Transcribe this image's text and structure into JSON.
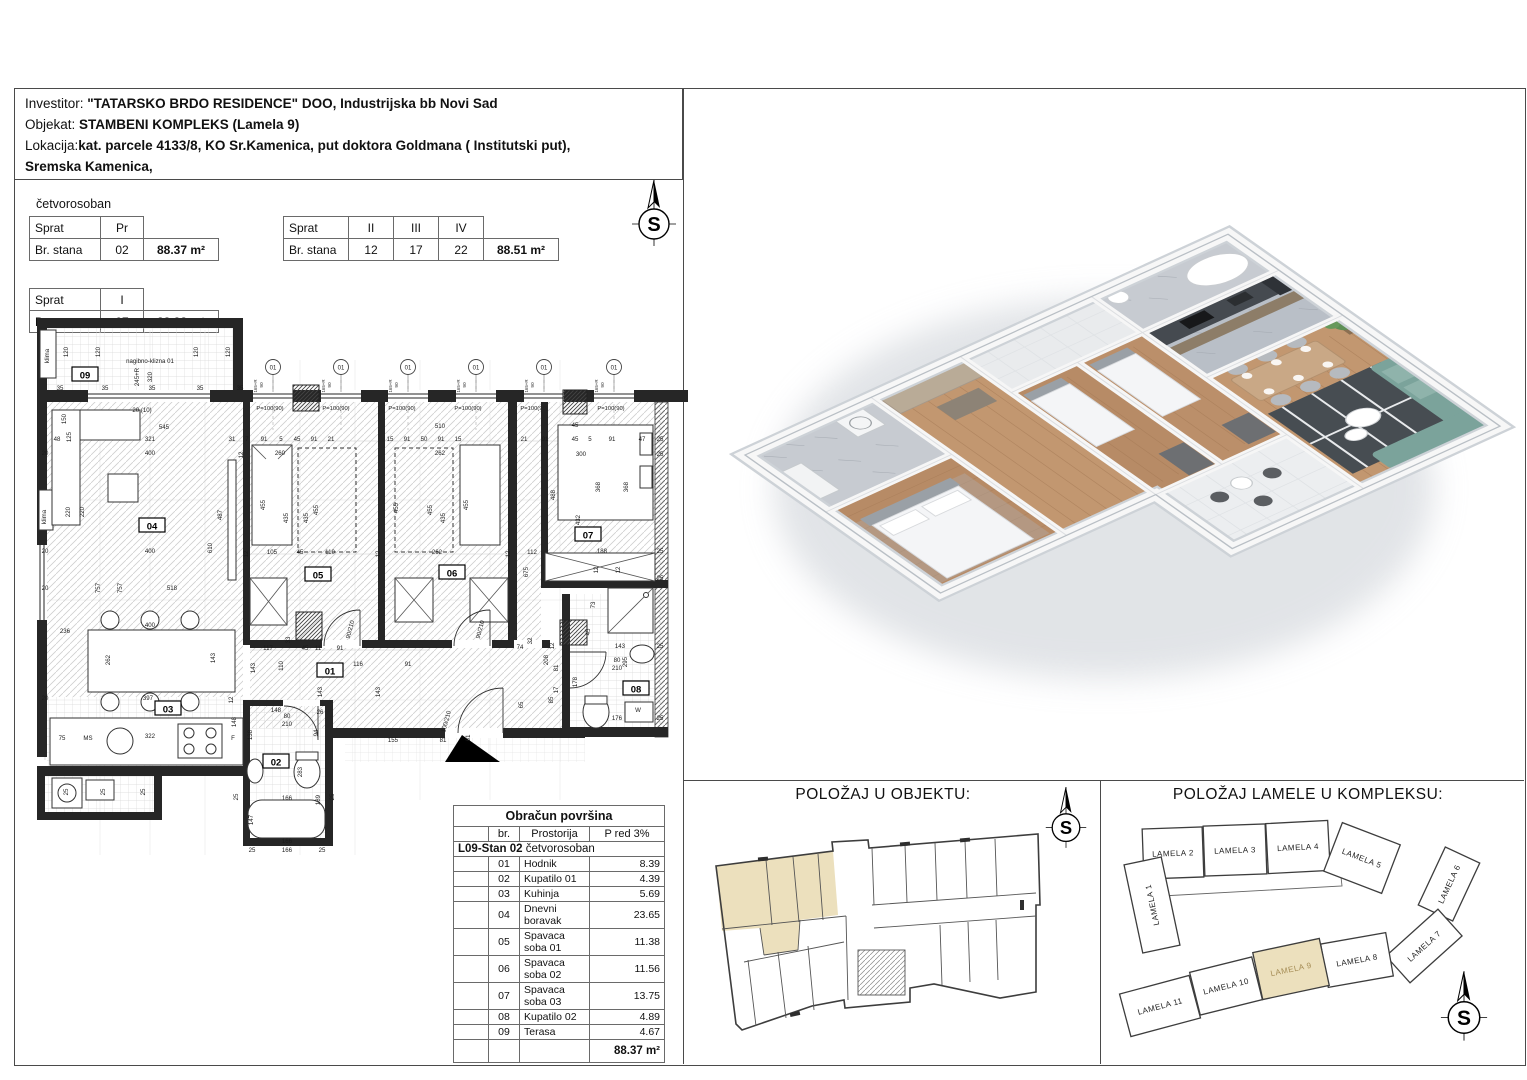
{
  "header": {
    "line1_label": "Investitor: ",
    "line1_value": "\"TATARSKO BRDO RESIDENCE\" DOO, Industrijska bb Novi Sad",
    "line2_label": "Objekat: ",
    "line2_value": "STAMBENI KOMPLEKS (Lamela 9)",
    "line3_label": "Lokacija:",
    "line3_value": "kat. parcele 4133/8, KO Sr.Kamenica, put doktora Goldmana ( Institutski put),",
    "line4_value": "Sremska Kamenica,"
  },
  "unit_type": "četvorosoban",
  "floor_tables": {
    "t1": {
      "c1": "Sprat",
      "c2": "Pr",
      "r2c1": "Br. stana",
      "r2c2": "02",
      "area": "88.37 m²"
    },
    "t2": {
      "c1": "Sprat",
      "c2": "II",
      "c3": "III",
      "c4": "IV",
      "r2c1": "Br. stana",
      "r2c2": "12",
      "r2c3": "17",
      "r2c4": "22",
      "area": "88.51 m²"
    },
    "t3": {
      "c1": "Sprat",
      "c2": "I",
      "r2c1": "Br. stana",
      "r2c2": "07",
      "area": "88,38 m²"
    }
  },
  "area_table": {
    "title": "Obračun površina",
    "col_br": "br.",
    "col_room": "Prostorija",
    "col_p": "P red 3%",
    "section_bold": "L09-Stan 02",
    "section_rest": " četvorosoban",
    "rows": [
      [
        "01",
        "Hodnik",
        "8.39"
      ],
      [
        "02",
        "Kupatilo 01",
        "4.39"
      ],
      [
        "03",
        "Kuhinja",
        "5.69"
      ],
      [
        "04",
        "Dnevni boravak",
        "23.65"
      ],
      [
        "05",
        "Spavaca soba 01",
        "11.38"
      ],
      [
        "06",
        "Spavaca soba 02",
        "11.56"
      ],
      [
        "07",
        "Spavaca soba 03",
        "13.75"
      ],
      [
        "08",
        "Kupatilo 02",
        "4.89"
      ],
      [
        "09",
        "Terasa",
        "4.67"
      ]
    ],
    "total": "88.37 m²"
  },
  "sections": {
    "objekat_title": "POLOŽAJ U OBJEKTU:",
    "kompleks_title": "POLOŽAJ LAMELE U KOMPLEKSU:"
  },
  "compass": {
    "letter": "S"
  },
  "colors": {
    "highlight": "#ECE0BD",
    "lamela_text_highlight": "#A58C55",
    "wood": "#B78B66",
    "tile": "#C7CBD1",
    "rug": "#474D52",
    "sofa": "#7BA39B",
    "counter": "#454A50"
  },
  "lamele": [
    {
      "t": "LAMELA 2",
      "x": 1173,
      "y": 853,
      "w": 60,
      "h": 50,
      "r": -2,
      "hl": false
    },
    {
      "t": "LAMELA 3",
      "x": 1235,
      "y": 850,
      "w": 62,
      "h": 50,
      "r": -2,
      "hl": false
    },
    {
      "t": "LAMELA 4",
      "x": 1298,
      "y": 847,
      "w": 62,
      "h": 50,
      "r": -3,
      "hl": false
    },
    {
      "t": "LAMELA 5",
      "x": 1362,
      "y": 858,
      "w": 62,
      "h": 52,
      "r": 21,
      "hl": false
    },
    {
      "t": "LAMELA 1",
      "x": 1152,
      "y": 905,
      "w": 38,
      "h": 90,
      "r": -12,
      "lr": -90,
      "hl": false
    },
    {
      "t": "LAMELA 6",
      "x": 1449,
      "y": 884,
      "w": 64,
      "h": 38,
      "r": -65,
      "hl": false
    },
    {
      "t": "LAMELA 7",
      "x": 1424,
      "y": 946,
      "w": 70,
      "h": 36,
      "r": -42,
      "hl": false
    },
    {
      "t": "LAMELA 8",
      "x": 1357,
      "y": 960,
      "w": 66,
      "h": 44,
      "r": -10,
      "hl": false
    },
    {
      "t": "LAMELA 9",
      "x": 1291,
      "y": 969,
      "w": 68,
      "h": 48,
      "r": -12,
      "hl": true
    },
    {
      "t": "LAMELA 10",
      "x": 1226,
      "y": 986,
      "w": 64,
      "h": 44,
      "r": -14,
      "hl": false
    },
    {
      "t": "LAMELA 11",
      "x": 1160,
      "y": 1006,
      "w": 72,
      "h": 44,
      "r": -15,
      "hl": false
    }
  ],
  "plan": {
    "marker_label": "01",
    "marker_sub1": "90",
    "marker_sub2": "165+R",
    "parapet_label": "P=100(90)",
    "window_marker_x": [
      273,
      341,
      408,
      476,
      544,
      614
    ],
    "parapet_x": [
      270,
      336,
      402,
      468,
      534,
      611
    ],
    "badges": [
      [
        85,
        376,
        "09"
      ],
      [
        152,
        527,
        "04"
      ],
      [
        168,
        710,
        "03"
      ],
      [
        330,
        672,
        "01"
      ],
      [
        276,
        763,
        "02"
      ],
      [
        318,
        576,
        "05"
      ],
      [
        452,
        574,
        "06"
      ],
      [
        588,
        536,
        "07"
      ],
      [
        636,
        690,
        "08"
      ]
    ],
    "dims": [
      [
        49,
        356,
        "klima",
        -90
      ],
      [
        150,
        363,
        "nagibno-klizna 01",
        0
      ],
      [
        139,
        377,
        "245+R",
        -90
      ],
      [
        152,
        377,
        "320",
        -90
      ],
      [
        68,
        352,
        "120",
        -90
      ],
      [
        100,
        352,
        "120",
        -90
      ],
      [
        198,
        352,
        "120",
        -90
      ],
      [
        230,
        352,
        "120",
        -90
      ],
      [
        60,
        390,
        "35",
        0
      ],
      [
        105,
        390,
        "35",
        0
      ],
      [
        152,
        390,
        "35",
        0
      ],
      [
        200,
        390,
        "35",
        0
      ],
      [
        240,
        390,
        "35",
        0
      ],
      [
        142,
        412,
        "20 (10)",
        0
      ],
      [
        164,
        429,
        "545",
        0
      ],
      [
        150,
        441,
        "321",
        0
      ],
      [
        57,
        441,
        "48",
        0
      ],
      [
        71,
        437,
        "125",
        -90
      ],
      [
        66,
        419,
        "150",
        -90
      ],
      [
        150,
        455,
        "400",
        0
      ],
      [
        45,
        455,
        "20",
        0
      ],
      [
        70,
        512,
        "220",
        -90
      ],
      [
        84,
        512,
        "220",
        -90
      ],
      [
        150,
        553,
        "400",
        0
      ],
      [
        45,
        553,
        "20",
        0
      ],
      [
        100,
        588,
        "757",
        -90
      ],
      [
        122,
        588,
        "757",
        -90
      ],
      [
        172,
        590,
        "518",
        0
      ],
      [
        45,
        590,
        "20",
        0
      ],
      [
        212,
        548,
        "610",
        -90
      ],
      [
        222,
        515,
        "487",
        -90
      ],
      [
        46,
        517,
        "klima",
        -90
      ],
      [
        65,
        633,
        "236",
        0
      ],
      [
        110,
        660,
        "262",
        -90
      ],
      [
        150,
        627,
        "400",
        0
      ],
      [
        215,
        658,
        "143",
        -90
      ],
      [
        148,
        700,
        "397",
        0
      ],
      [
        45,
        700,
        "20",
        0
      ],
      [
        233,
        700,
        "12",
        -90
      ],
      [
        88,
        740,
        "MS",
        0
      ],
      [
        62,
        740,
        "75",
        0
      ],
      [
        150,
        738,
        "322",
        0
      ],
      [
        233,
        740,
        "F",
        0
      ],
      [
        236,
        722,
        "148",
        -90
      ],
      [
        68,
        792,
        "25",
        -90
      ],
      [
        105,
        792,
        "25",
        -90
      ],
      [
        145,
        792,
        "25",
        -90
      ],
      [
        268,
        650,
        "117",
        0
      ],
      [
        305,
        650,
        "45",
        0
      ],
      [
        318,
        650,
        "11",
        0
      ],
      [
        340,
        650,
        "91",
        0
      ],
      [
        358,
        666,
        "116",
        0
      ],
      [
        408,
        666,
        "91",
        0
      ],
      [
        255,
        668,
        "143",
        -90
      ],
      [
        283,
        666,
        "110",
        -90
      ],
      [
        322,
        692,
        "143",
        -90
      ],
      [
        380,
        692,
        "143",
        -90
      ],
      [
        290,
        640,
        "33",
        -90
      ],
      [
        520,
        649,
        "74",
        0
      ],
      [
        532,
        641,
        "32",
        -90
      ],
      [
        548,
        660,
        "208",
        -90
      ],
      [
        553,
        700,
        "85",
        -90
      ],
      [
        523,
        705,
        "65",
        -90
      ],
      [
        393,
        742,
        "155",
        0
      ],
      [
        443,
        742,
        "81",
        0
      ],
      [
        470,
        738,
        "61",
        -90
      ],
      [
        448,
        722,
        "100/210",
        -75
      ],
      [
        352,
        630,
        "90/210",
        -75
      ],
      [
        482,
        630,
        "90/210",
        -75
      ],
      [
        287,
        718,
        "80",
        0
      ],
      [
        287,
        726,
        "210",
        0
      ],
      [
        617,
        662,
        "80",
        0
      ],
      [
        617,
        670,
        "210",
        0
      ],
      [
        276,
        712,
        "148",
        0
      ],
      [
        320,
        714,
        "26",
        0
      ],
      [
        318,
        733,
        "94",
        -90
      ],
      [
        252,
        735,
        "138",
        -90
      ],
      [
        287,
        800,
        "166",
        0
      ],
      [
        253,
        820,
        "147",
        -90
      ],
      [
        320,
        800,
        "189",
        -90
      ],
      [
        302,
        772,
        "283",
        -90
      ],
      [
        287,
        843,
        "166",
        0
      ],
      [
        252,
        852,
        "25",
        0
      ],
      [
        287,
        852,
        "166",
        0
      ],
      [
        322,
        852,
        "25",
        0
      ],
      [
        238,
        797,
        "25",
        -90
      ],
      [
        334,
        797,
        "25",
        -90
      ],
      [
        232,
        441,
        "31",
        0
      ],
      [
        247,
        441,
        "7",
        0
      ],
      [
        264,
        441,
        "91",
        0
      ],
      [
        281,
        441,
        "5",
        0
      ],
      [
        297,
        441,
        "45",
        0
      ],
      [
        314,
        441,
        "91",
        0
      ],
      [
        331,
        441,
        "21",
        0
      ],
      [
        390,
        441,
        "15",
        0
      ],
      [
        407,
        441,
        "91",
        0
      ],
      [
        424,
        441,
        "50",
        0
      ],
      [
        441,
        441,
        "91",
        0
      ],
      [
        458,
        441,
        "15",
        0
      ],
      [
        243,
        455,
        "12",
        -90
      ],
      [
        280,
        455,
        "260",
        0
      ],
      [
        440,
        455,
        "262",
        0
      ],
      [
        440,
        428,
        "510",
        0
      ],
      [
        265,
        505,
        "455",
        -90
      ],
      [
        288,
        518,
        "435",
        -90
      ],
      [
        308,
        518,
        "435",
        -90
      ],
      [
        318,
        510,
        "455",
        -90
      ],
      [
        272,
        554,
        "105",
        0
      ],
      [
        300,
        554,
        "45",
        0
      ],
      [
        330,
        554,
        "110",
        0
      ],
      [
        248,
        554,
        "12",
        -90
      ],
      [
        398,
        508,
        "455",
        -90
      ],
      [
        432,
        510,
        "455",
        -90
      ],
      [
        468,
        505,
        "455",
        -90
      ],
      [
        445,
        518,
        "435",
        -90
      ],
      [
        437,
        554,
        "262",
        0
      ],
      [
        510,
        554,
        "12",
        -90
      ],
      [
        532,
        554,
        "112",
        0
      ],
      [
        528,
        572,
        "675",
        -90
      ],
      [
        380,
        554,
        "12",
        -90
      ],
      [
        524,
        441,
        "21",
        0
      ],
      [
        545,
        441,
        "91",
        0
      ],
      [
        575,
        441,
        "45",
        0
      ],
      [
        590,
        441,
        "5",
        0
      ],
      [
        612,
        441,
        "91",
        0
      ],
      [
        642,
        441,
        "47",
        0
      ],
      [
        575,
        427,
        "45",
        0
      ],
      [
        581,
        456,
        "300",
        0
      ],
      [
        600,
        487,
        "368",
        -90
      ],
      [
        628,
        487,
        "368",
        -90
      ],
      [
        555,
        495,
        "488",
        -90
      ],
      [
        580,
        520,
        "432",
        -90
      ],
      [
        602,
        553,
        "188",
        0
      ],
      [
        598,
        570,
        "12",
        -90
      ],
      [
        620,
        570,
        "12",
        -90
      ],
      [
        660,
        441,
        "25",
        0
      ],
      [
        660,
        456,
        "25",
        0
      ],
      [
        660,
        553,
        "25",
        0
      ],
      [
        660,
        580,
        "25",
        0
      ],
      [
        660,
        648,
        "25",
        0
      ],
      [
        660,
        720,
        "25",
        0
      ],
      [
        595,
        605,
        "73",
        -90
      ],
      [
        590,
        632,
        "45",
        -90
      ],
      [
        620,
        648,
        "143",
        0
      ],
      [
        627,
        662,
        "295",
        -90
      ],
      [
        617,
        720,
        "176",
        0
      ],
      [
        638,
        712,
        "W",
        0
      ],
      [
        558,
        690,
        "17",
        -90
      ],
      [
        558,
        668,
        "81",
        -90
      ],
      [
        554,
        646,
        "12",
        -90
      ],
      [
        577,
        682,
        "178",
        -90
      ]
    ]
  }
}
